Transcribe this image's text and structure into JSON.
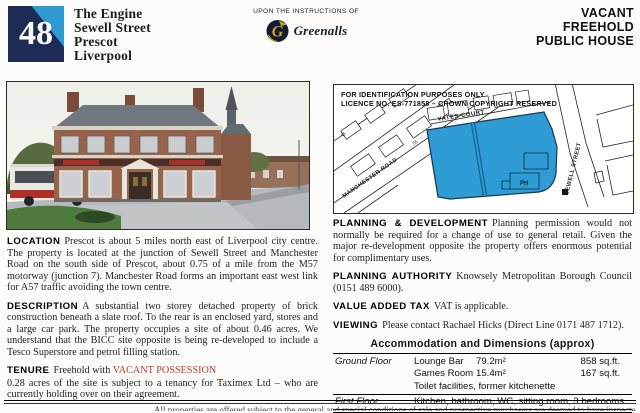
{
  "header": {
    "lot_number": "48",
    "title_lines": [
      "The Engine",
      "Sewell Street",
      "Prescot",
      "Liverpool"
    ],
    "instructions_label": "UPON THE INSTRUCTIONS OF",
    "brand_name": "Greenalls",
    "status_lines": [
      "VACANT",
      "FREEHOLD",
      "PUBLIC HOUSE"
    ],
    "badge_navy": "#1e2c55",
    "badge_blue": "#2f9ad2"
  },
  "map": {
    "notice_lines": [
      "FOR IDENTIFICATION PURPOSES ONLY",
      "LICENCE NO. ES-771858 – CROWN COPYRIGHT RESERVED"
    ],
    "labels": {
      "yates_court": "YATES COURT",
      "sewell_street": "SEWELL STREET",
      "manchester_road": "MANCHESTER ROAD",
      "ph": "PH",
      "plot_45": "45",
      "plot_55": "55"
    },
    "site_color": "#2f9cd6"
  },
  "sections": {
    "location": {
      "heading": "LOCATION",
      "body": "Prescot is about 5 miles north east of Liverpool city centre. The property is located at the junction of Sewell Street and Manchester Road on the south side of Prescot, about 0.75 of a mile from the M57 motorway (junction 7). Manchester Road forms an important east west link for A57 traffic avoiding the town centre."
    },
    "description": {
      "heading": "DESCRIPTION",
      "body": "A substantial two storey detached property of brick construction beneath a slate roof. To the rear is an enclosed yard, stores and a large car park. The property occupies a site of about 0.46 acres. We understand that the BICC site opposite is being re-developed to include a Tesco Superstore and petrol filling station."
    },
    "tenure": {
      "heading": "TENURE",
      "lead": "Freehold with ",
      "highlight": "VACANT POSSESSION",
      "body": "0.28 acres of the site is subject to a tenancy for Taximex Ltd – who are currently holding over on their agreement."
    },
    "planning_development": {
      "heading": "PLANNING & DEVELOPMENT",
      "body": "Planning permission would not normally be required for a change of use to general retail. Given the major re-development opposite the property offers enormous potential for complimentary uses."
    },
    "planning_authority": {
      "heading": "PLANNING AUTHORITY",
      "body": "Knowsely Metropolitan Borough Council (0151 489 6000)."
    },
    "vat": {
      "heading": "VALUE ADDED TAX",
      "body": "VAT is applicable."
    },
    "viewing": {
      "heading": "VIEWING",
      "body": "Please contact Rachael Hicks (Direct Line 0171 487 1712)."
    }
  },
  "accommodation": {
    "title": "Accommodation and Dimensions (approx)",
    "rows": [
      {
        "floor": "Ground Floor",
        "name": "Lounge Bar",
        "metric": "79.2m²",
        "imperial": "858 sq.ft."
      },
      {
        "floor": "",
        "name": "Games Room",
        "metric": "15.4m²",
        "imperial": "167 sq.ft."
      },
      {
        "floor": "",
        "name": "Toilet facilities, former kitchenette",
        "metric": "",
        "imperial": ""
      },
      {
        "floor": "First Floor",
        "name": "Kitchen, bathroom, WC, sitting room, 3 bedrooms",
        "metric": "",
        "imperial": ""
      }
    ]
  },
  "footer": {
    "clipped_text": "All properties are offered subject to the general and special conditions of sale and prospective purchasers are deemed to have inspected the properties and made all usual enquiries"
  }
}
